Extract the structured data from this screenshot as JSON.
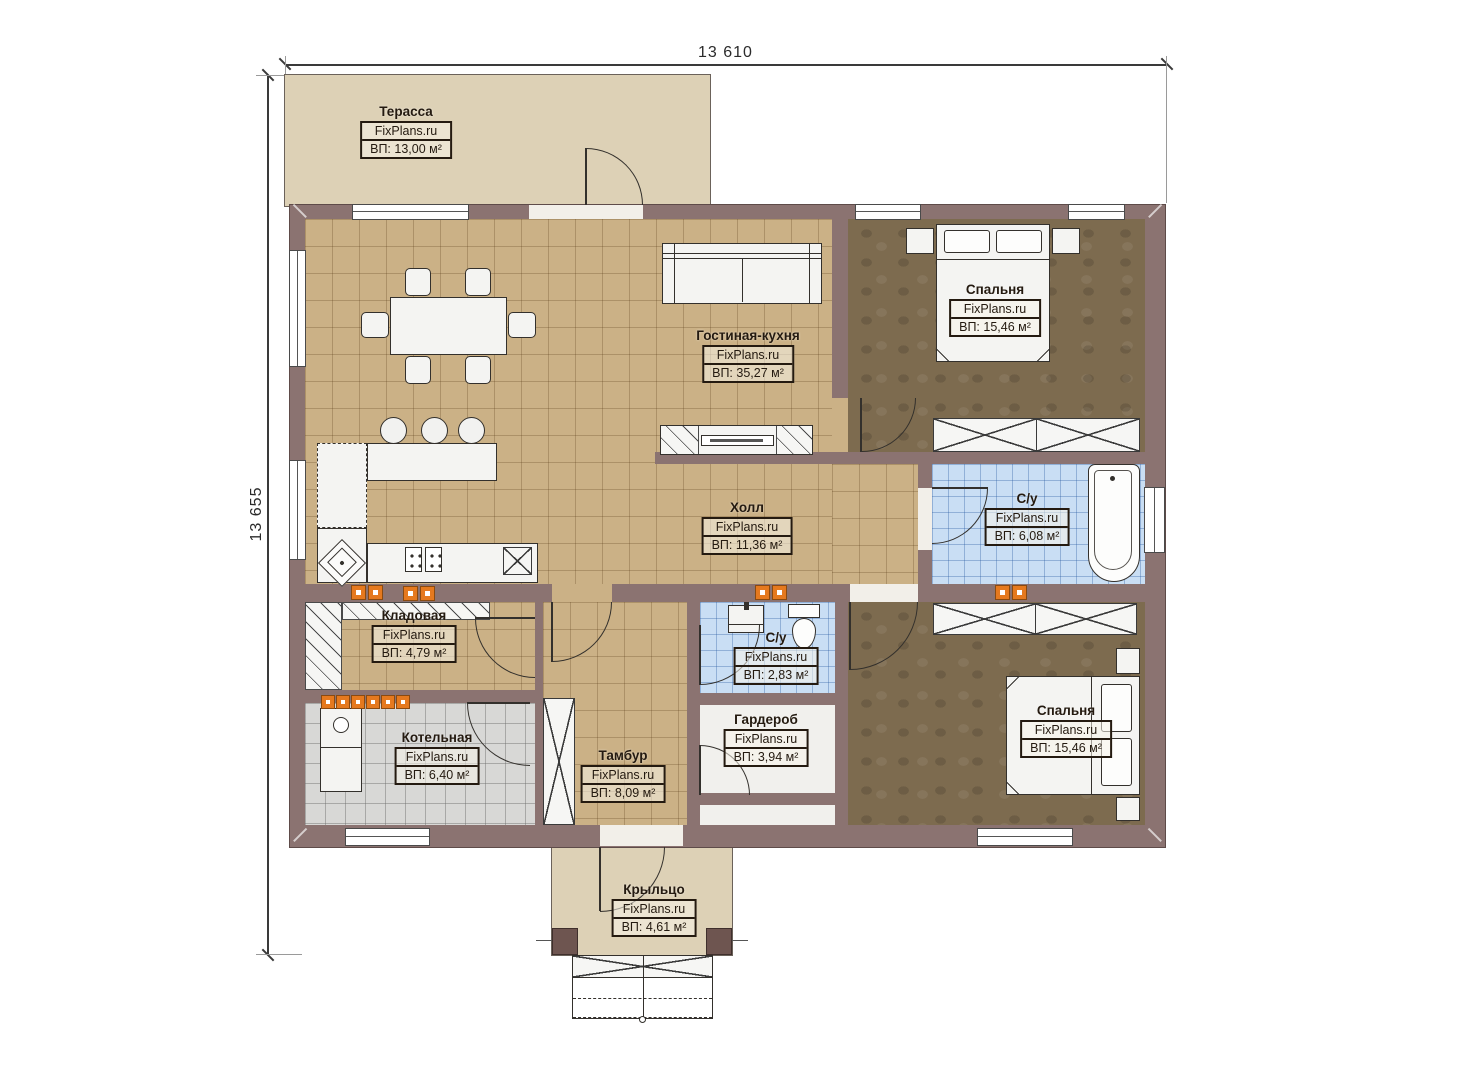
{
  "dimensions": {
    "top": "13 610",
    "left": "13 655"
  },
  "watermark": "FixPlans.ru",
  "colors": {
    "wall": "#8b7371",
    "floor_tan": "#cbb186",
    "floor_blue": "#c9def4",
    "floor_grey": "#d8d8d6",
    "floor_dark": "#7d6b4f",
    "terrace": "#ddd1b6",
    "radiator_orange": "#e5791e"
  },
  "rooms": [
    {
      "name": "Терасса",
      "brand": "FixPlans.ru",
      "area": "ВП: 13,00 м²"
    },
    {
      "name": "Гостиная-кухня",
      "brand": "FixPlans.ru",
      "area": "ВП: 35,27 м²"
    },
    {
      "name": "Спальня",
      "brand": "FixPlans.ru",
      "area": "ВП: 15,46 м²"
    },
    {
      "name": "Холл",
      "brand": "FixPlans.ru",
      "area": "ВП: 11,36 м²"
    },
    {
      "name": "С/у",
      "brand": "FixPlans.ru",
      "area": "ВП: 6,08 м²"
    },
    {
      "name": "Кладовая",
      "brand": "FixPlans.ru",
      "area": "ВП: 4,79 м²"
    },
    {
      "name": "С/у",
      "brand": "FixPlans.ru",
      "area": "ВП: 2,83 м²"
    },
    {
      "name": "Гардероб",
      "brand": "FixPlans.ru",
      "area": "ВП: 3,94 м²"
    },
    {
      "name": "Котельная",
      "brand": "FixPlans.ru",
      "area": "ВП: 6,40 м²"
    },
    {
      "name": "Тамбур",
      "brand": "FixPlans.ru",
      "area": "ВП: 8,09 м²"
    },
    {
      "name": "Спальня",
      "brand": "FixPlans.ru",
      "area": "ВП: 15,46 м²"
    },
    {
      "name": "Крыльцо",
      "brand": "FixPlans.ru",
      "area": "ВП: 4,61 м²"
    }
  ]
}
